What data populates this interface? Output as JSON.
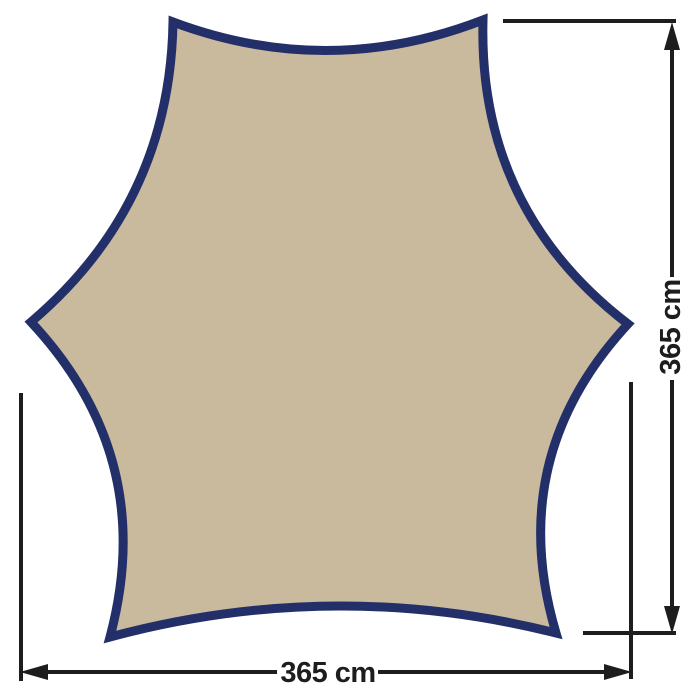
{
  "diagram": {
    "kind": "product-dimension-diagram",
    "shape": "hexagonal-tarp-concave-edges",
    "dimensions": {
      "width": {
        "label": "365 cm",
        "value": 365,
        "unit": "cm"
      },
      "height": {
        "label": "365 cm",
        "value": 365,
        "unit": "cm"
      }
    },
    "colors": {
      "tarp_fill": "#c9b99d",
      "tarp_border": "#232f69",
      "dimension": "#1d1d1b",
      "background": "#ffffff"
    }
  }
}
